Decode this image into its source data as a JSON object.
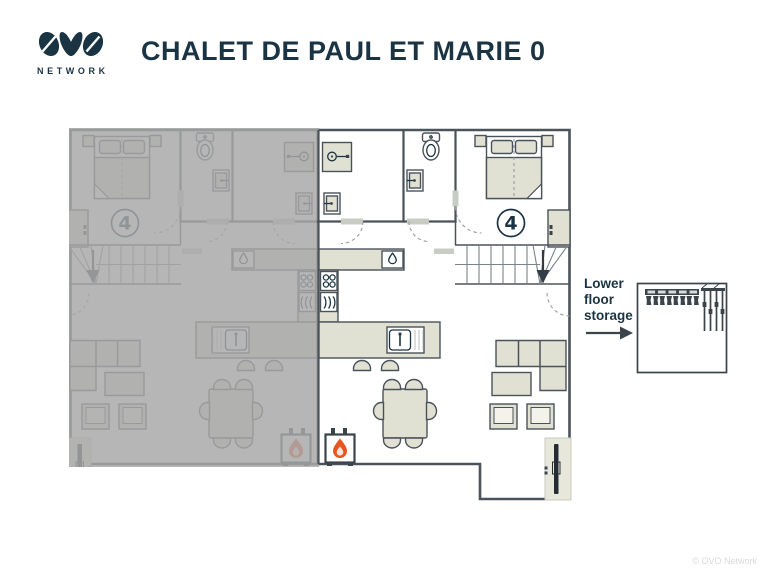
{
  "header": {
    "logo": {
      "brand": "OVO",
      "subtitle": "NETWORK"
    },
    "title": "CHALET DE PAUL ET MARIE 0"
  },
  "floor_plan": {
    "capacity_badge": "4",
    "inactive_half": "left",
    "icons": [
      "double-bed",
      "nightstand",
      "wardrobe",
      "shower",
      "washbasin",
      "toilet",
      "stairs-down-arrow",
      "kitchen-counter",
      "boiler-droplet",
      "stove",
      "oven",
      "island-sink",
      "bar-stool",
      "dining-table",
      "dining-chair",
      "fireplace-flame",
      "corner-sofa",
      "coffee-table",
      "armchair",
      "wall-tv",
      "door-swing"
    ]
  },
  "storage_note": {
    "label": "Lower floor storage",
    "items": [
      "ski-boot-rack",
      "ski-rack"
    ]
  },
  "footer": {
    "copyright": "© OVO Network"
  },
  "colors": {
    "navy": "#1b3443",
    "wall": "#4a525a",
    "furniture": "#e1e1d3",
    "overlay": "#a8a8a8",
    "flame": "#e8551f",
    "copyright_grey": "#d9d9d9"
  }
}
